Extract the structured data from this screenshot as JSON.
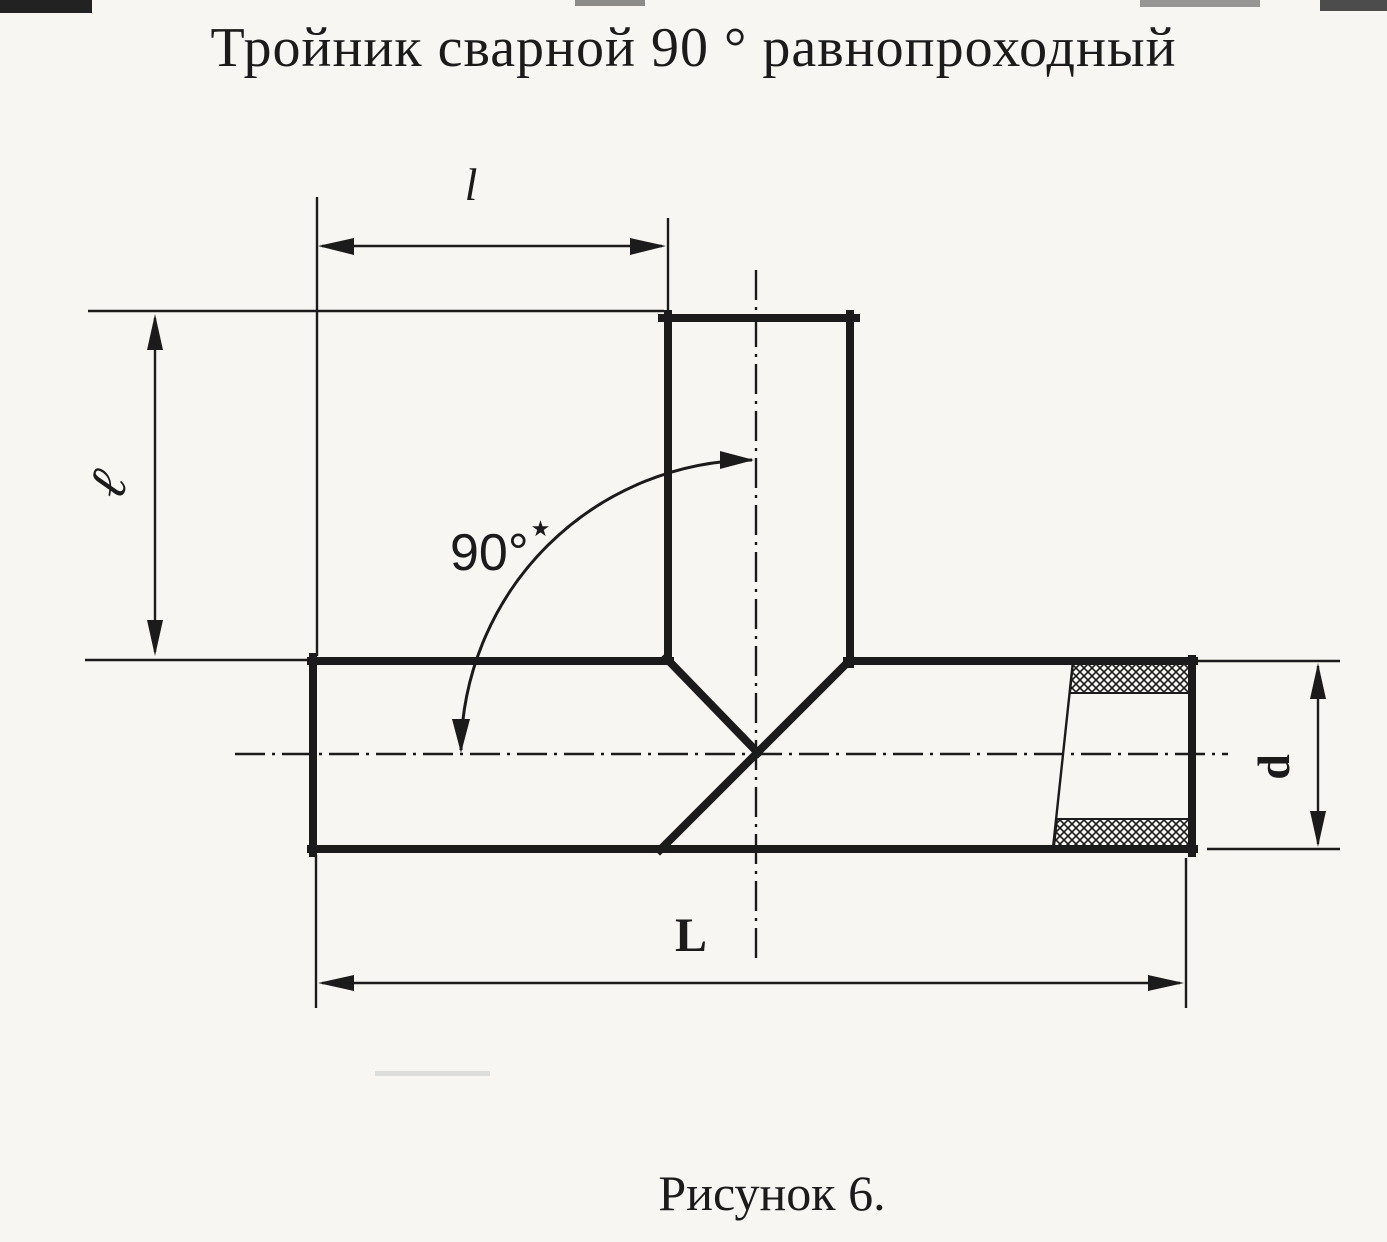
{
  "figure": {
    "title": "Тройник сварной 90 ° равнопроходный",
    "caption": "Рисунок 6."
  },
  "labels": {
    "branch_length": "l",
    "branch_height": "ℓ",
    "angle": "90°",
    "angle_note_mark": "★",
    "diameter": "d",
    "overall_length": "L"
  },
  "colors": {
    "ink": "#1b1b1b",
    "paper": "#f7f6f3"
  }
}
